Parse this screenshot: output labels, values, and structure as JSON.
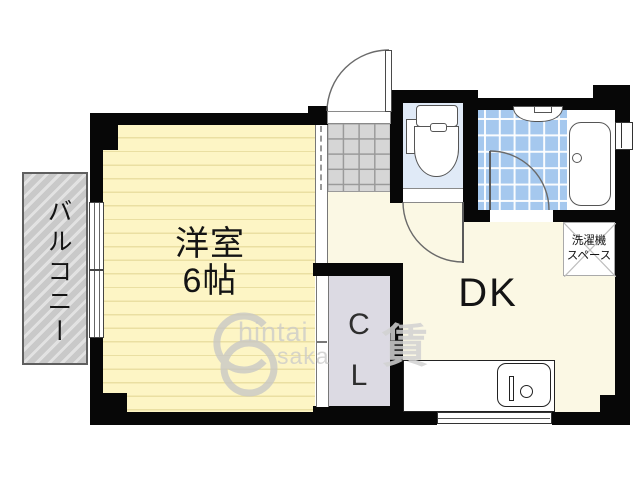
{
  "rooms": {
    "western_room": {
      "name": "洋室",
      "size": "6帖"
    },
    "dining_kitchen": {
      "name": "DK"
    },
    "closet": {
      "line1": "C",
      "line2": "L"
    },
    "balcony": {
      "name": "バルコニー"
    },
    "laundry_space": {
      "line1": "洗濯機",
      "line2": "スペース"
    }
  },
  "watermark": {
    "text_top": "hintai",
    "text_bottom": "saka",
    "kanji": "賃"
  },
  "colors": {
    "wall": "#070707",
    "western_room_floor": "#fdf5c5",
    "dk_floor": "#fbf8e4",
    "bath_tile": "#a5c8ee",
    "toilet_floor": "#e0eaf7",
    "closet_floor": "#dcdae3",
    "genkan_tile": "#d6d6d6",
    "balcony": "#c9c9c9"
  }
}
